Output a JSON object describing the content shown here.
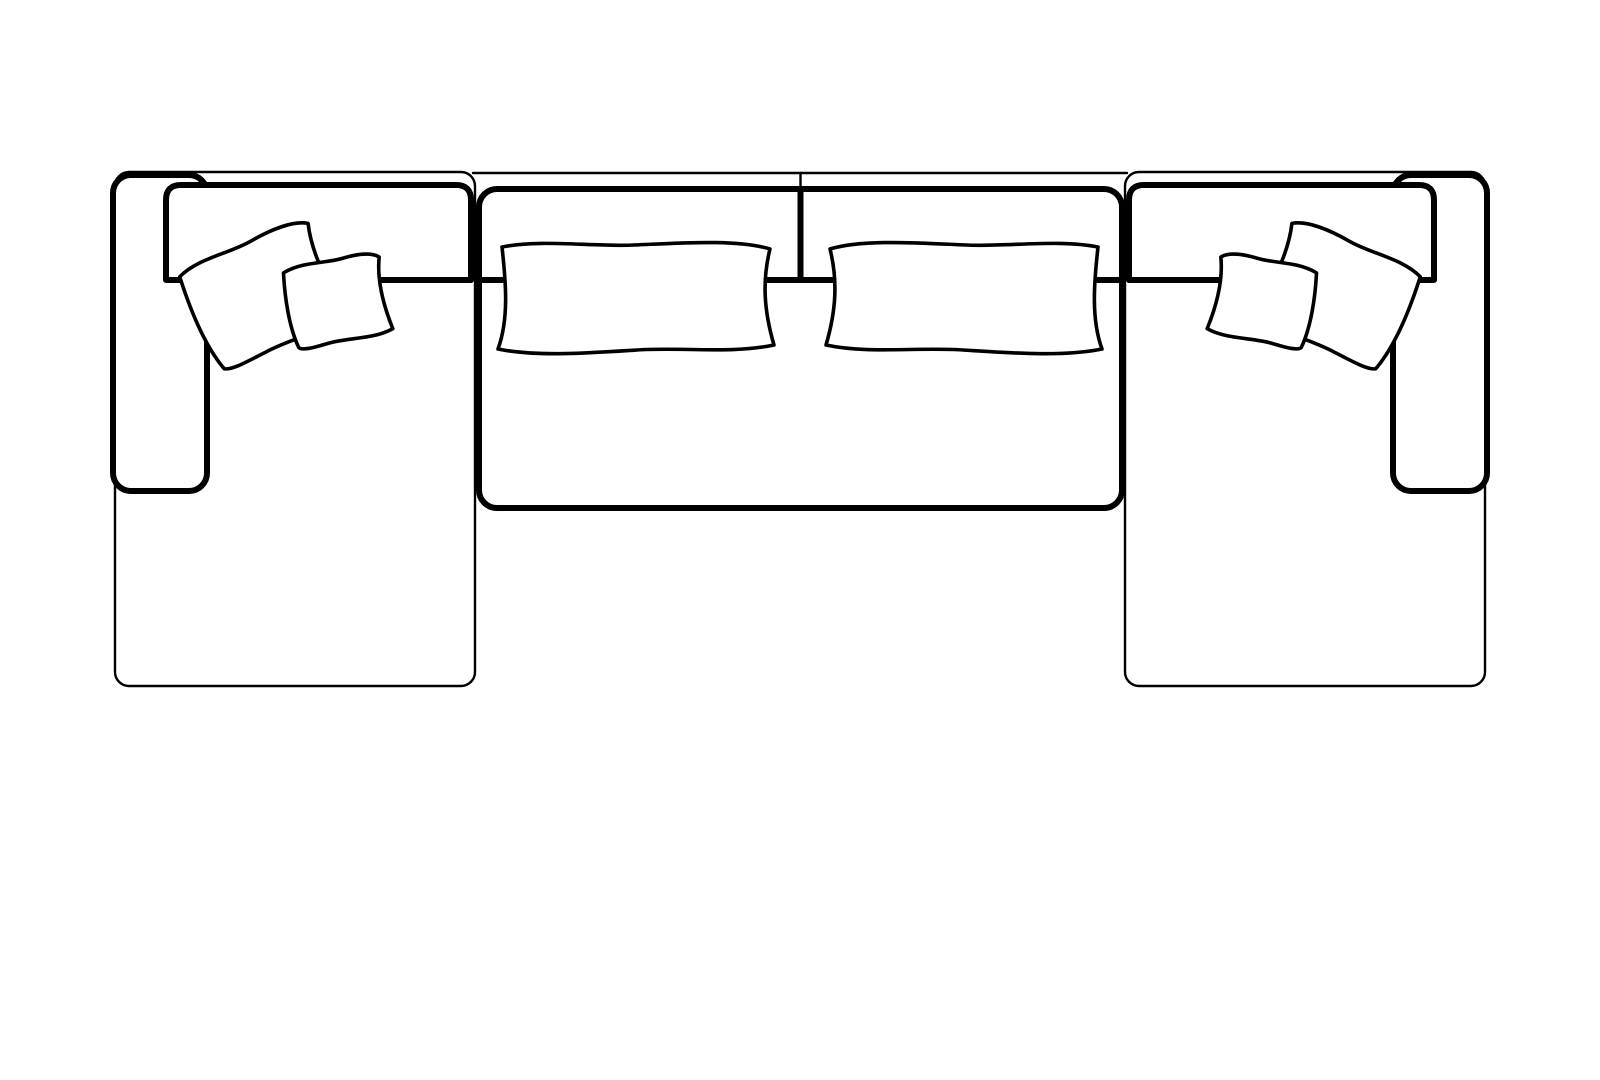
{
  "drawing": {
    "description": "Top-down line drawing of a U-shaped sectional sofa: left and right chaise ends with arms, two center seats, two lumbar pillows, and two overlapping throw pillows on each chaise",
    "canvas": {
      "width": 1600,
      "height": 1080
    },
    "colors": {
      "background": "#ffffff",
      "line": "#000000",
      "fill": "#ffffff"
    },
    "components": [
      {
        "name": "left-chaise-body"
      },
      {
        "name": "left-arm"
      },
      {
        "name": "left-backrest"
      },
      {
        "name": "left-throw-pillow-large"
      },
      {
        "name": "left-throw-pillow-small"
      },
      {
        "name": "center-seat-left"
      },
      {
        "name": "center-seat-right"
      },
      {
        "name": "center-backrest-line"
      },
      {
        "name": "lumbar-pillow-left"
      },
      {
        "name": "lumbar-pillow-right"
      },
      {
        "name": "right-chaise-body"
      },
      {
        "name": "right-arm"
      },
      {
        "name": "right-backrest"
      },
      {
        "name": "right-throw-pillow-large"
      },
      {
        "name": "right-throw-pillow-small"
      }
    ]
  }
}
